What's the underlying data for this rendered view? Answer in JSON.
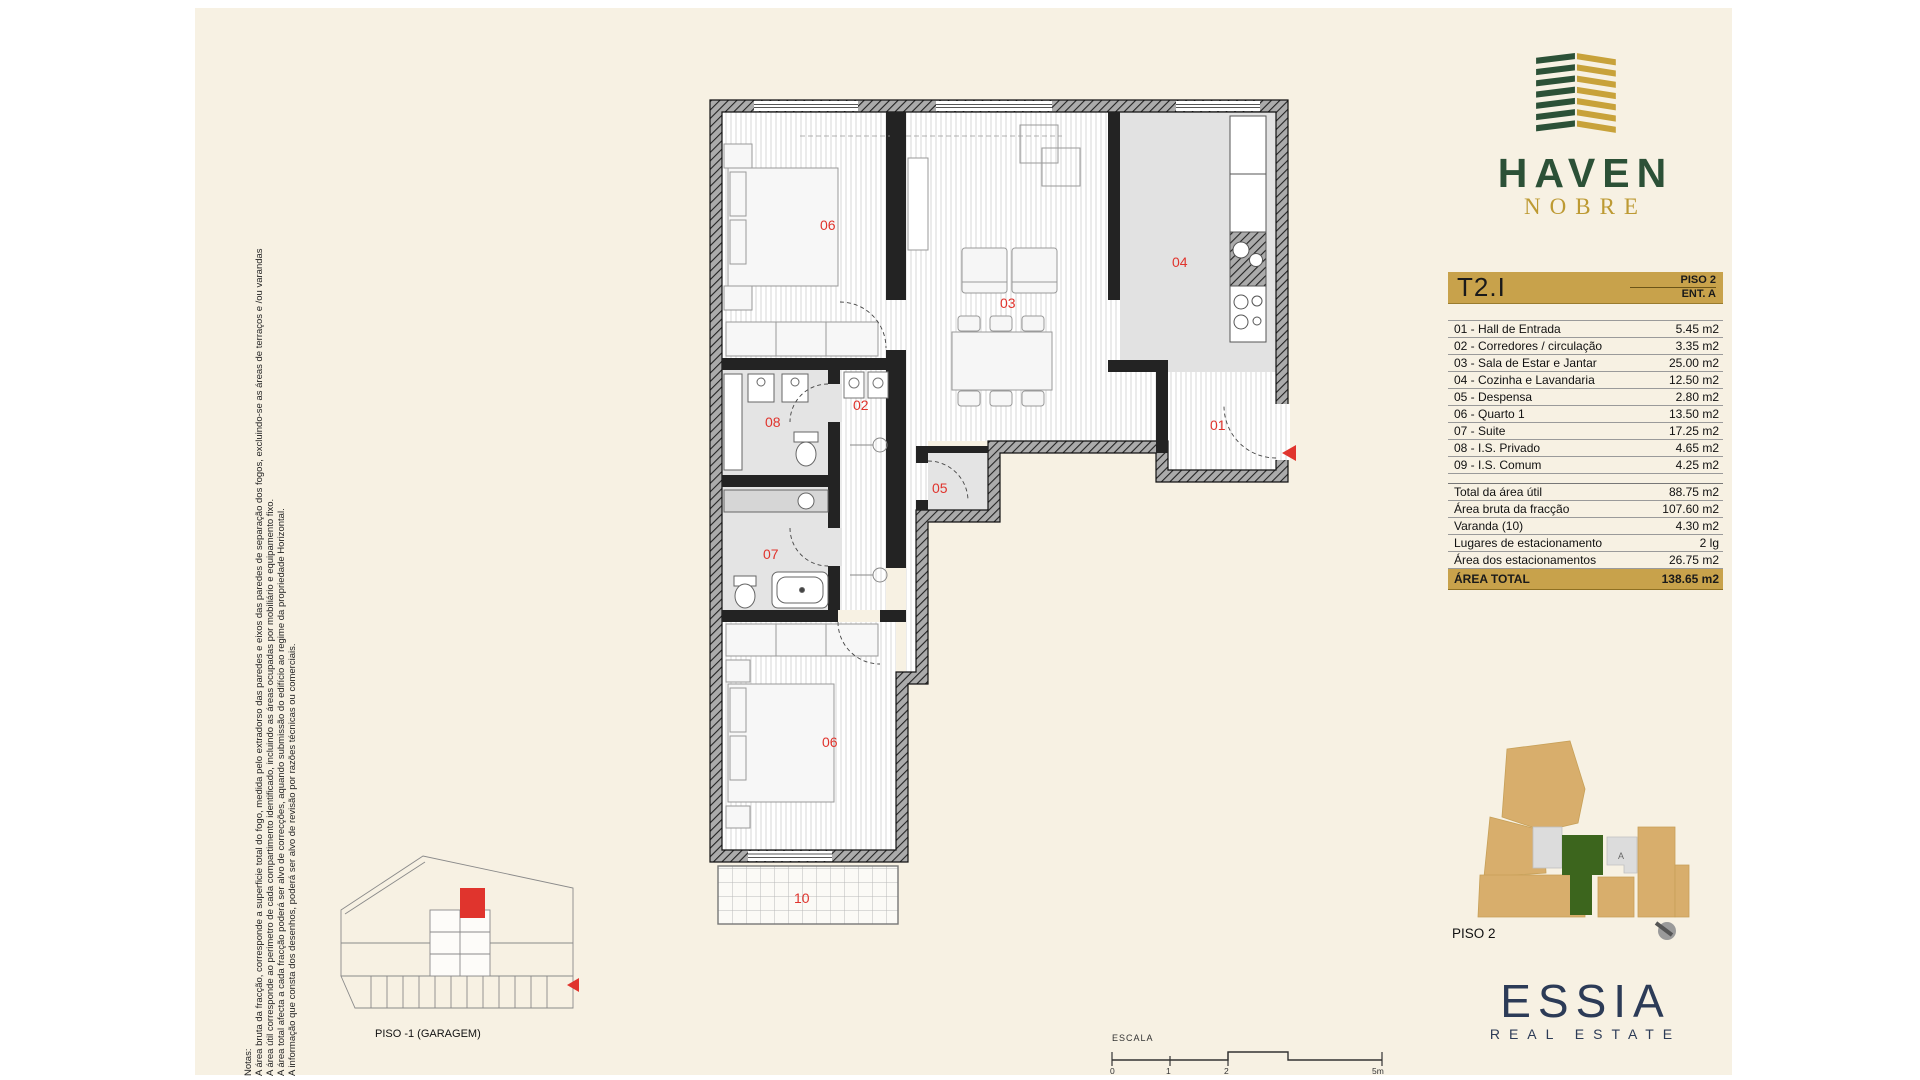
{
  "brand": {
    "name": "HAVEN",
    "subname": "NOBRE",
    "green": "#2c5137",
    "gold": "#c8a24b"
  },
  "unit": {
    "code": "T2.I",
    "floor": "PISO 2",
    "entrance": "ENT. A"
  },
  "rooms": [
    {
      "label": "01 - Hall de Entrada",
      "area": "5.45 m2"
    },
    {
      "label": "02 - Corredores / circulação",
      "area": "3.35 m2"
    },
    {
      "label": "03 - Sala de Estar e Jantar",
      "area": "25.00 m2"
    },
    {
      "label": "04 - Cozinha e Lavandaria",
      "area": "12.50 m2"
    },
    {
      "label": "05 - Despensa",
      "area": "2.80 m2"
    },
    {
      "label": "06 - Quarto 1",
      "area": "13.50 m2"
    },
    {
      "label": "07 - Suite",
      "area": "17.25 m2"
    },
    {
      "label": "08 - I.S. Privado",
      "area": "4.65 m2"
    },
    {
      "label": "09 - I.S. Comum",
      "area": "4.25 m2"
    }
  ],
  "totals": [
    {
      "label": "Total da área útil",
      "value": "88.75 m2"
    },
    {
      "label": "Área bruta da fracção",
      "value": "107.60 m2"
    },
    {
      "label": "Varanda (10)",
      "value": "4.30 m2"
    },
    {
      "label": "Lugares de estacionamento",
      "value": "2 lg"
    },
    {
      "label": "Área dos estacionamentos",
      "value": "26.75 m2"
    }
  ],
  "area_total": {
    "label": "ÁREA TOTAL",
    "value": "138.65 m2"
  },
  "site_plan": {
    "floor_label": "PISO 2",
    "unit_letter": "A",
    "tan": "#d8ae6c",
    "green": "#3c651d"
  },
  "plan": {
    "room_numbers": {
      "bedroom1": "06",
      "living": "03",
      "kitchen": "04",
      "hall": "01",
      "corridor": "02",
      "wc_private": "08",
      "pantry": "05",
      "wc_suite": "07",
      "suite": "06",
      "balcony": "10"
    },
    "garage_label": "PISO -1 (GARAGEM)",
    "scale": {
      "title": "ESCALA",
      "tick0": "0",
      "tick1": "1",
      "tick2": "2",
      "tick3": "5m"
    }
  },
  "notes": {
    "title": "Notas:",
    "line1": "A área bruta da fracção, corresponde a superficie total do fogo, medida pelo extradorso das paredes e eixos das paredes de separação dos fogos, excluindo-se as áreas de terraços e /ou varandas",
    "line2": "A área útil corresponde ao perimetro de cada compartimento identificado, incluindo as áreas ocupadas por mobiliário e equipamento fixo.",
    "line3": "A área total afecta a cada fracção poderá ser alvo de correcções, aquando submissão do edifício ao regime da propriedade Horizontal.",
    "line4": "A informação que consta dos desenhos, poderá ser alvo de revisão por razões técnicas ou comerciais."
  },
  "footer_brand": {
    "name": "ESSIA",
    "tagline": "REAL ESTATE",
    "navy": "#2c3b57"
  }
}
